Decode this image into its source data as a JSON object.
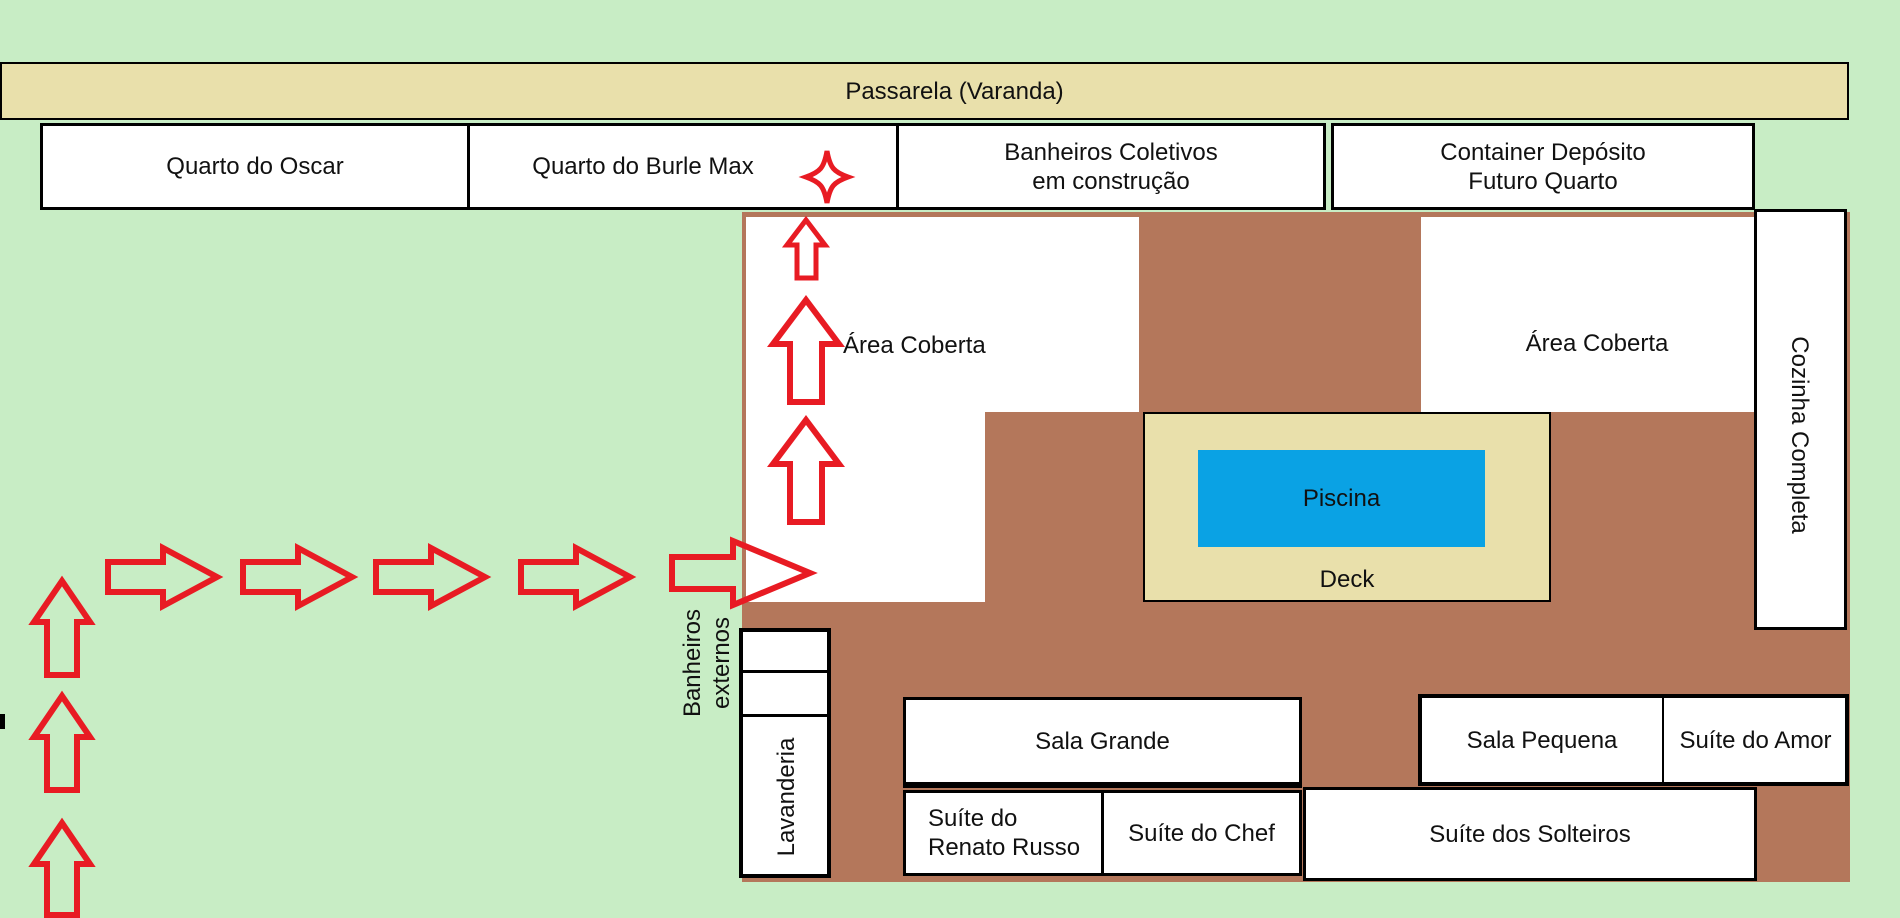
{
  "colors": {
    "background": "#c8edc5",
    "walkway_tan": "#e9e0ab",
    "floor_brown": "#b4775b",
    "pool_blue": "#0aa2e4",
    "arrow_red": "#e81b23",
    "room_white": "#ffffff",
    "border_black": "#000000"
  },
  "walkway": {
    "label": "Passarela (Varanda)"
  },
  "top_row": {
    "quarto_oscar": "Quarto do Oscar",
    "quarto_burle_max": "Quarto do Burle Max",
    "banheiros_coletivos_line1": "Banheiros Coletivos",
    "banheiros_coletivos_line2": "em construção",
    "container_line1": "Container Depósito",
    "container_line2": "Futuro Quarto"
  },
  "main_house": {
    "area_coberta_left": "Área Coberta",
    "area_coberta_right": "Área Coberta",
    "cozinha": "Cozinha Completa",
    "piscina": "Piscina",
    "deck": "Deck",
    "lavanderia": "Lavanderia",
    "sala_grande": "Sala Grande",
    "sala_pequena": "Sala Pequena",
    "suite_do_amor": "Suíte do Amor",
    "suite_renato_line1": "Suíte do",
    "suite_renato_line2": "Renato Russo",
    "suite_do_chef": "Suíte do Chef",
    "suite_dos_solteiros": "Suíte dos Solteiros"
  },
  "outside": {
    "banheiros_externos_line1": "Banheiros",
    "banheiros_externos_line2": "externos"
  }
}
